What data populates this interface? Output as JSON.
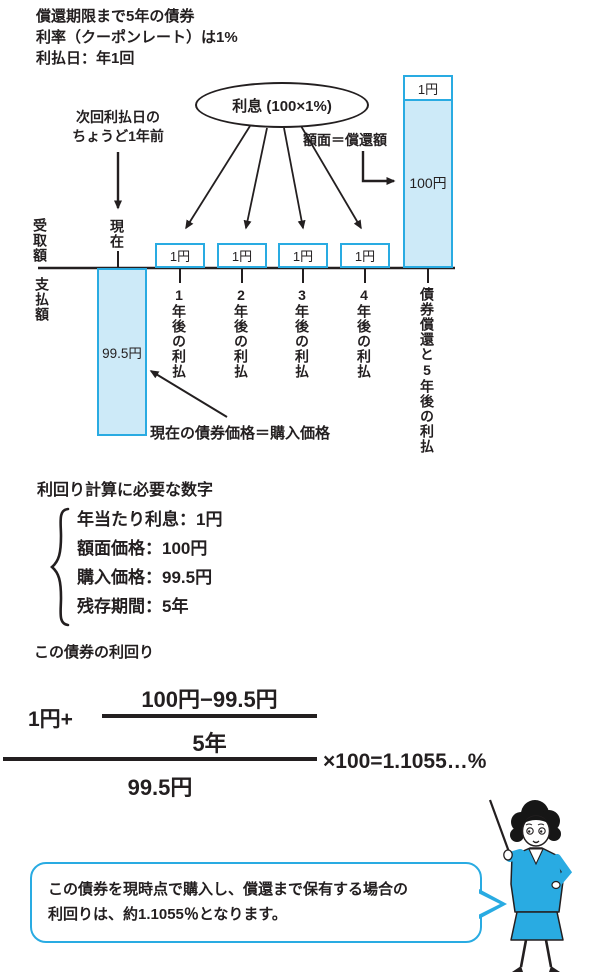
{
  "colors": {
    "accent": "#29abe2",
    "fill": "#cdeaf8",
    "ink": "#231f20"
  },
  "header": {
    "line1": "償還期限まで5年の債券",
    "line2": "利率（クーポンレート）は1%",
    "line3": "利払日：年1回"
  },
  "diagram": {
    "interest_oval": "利息 (100×1%)",
    "next_payment_note_line1": "次回利払日の",
    "next_payment_note_line2": "ちょうど1年前",
    "face_value_note": "額面＝償還額",
    "axis_receive": "受取額",
    "axis_pay": "支払額",
    "now_label": "現在",
    "coupon_boxes": [
      "1円",
      "1円",
      "1円",
      "1円"
    ],
    "top_coupon": "1円",
    "face_value": "100円",
    "purchase_price": "99.5円",
    "price_note": "現在の債券価格＝購入価格",
    "year_labels": [
      "1年後の利払",
      "2年後の利払",
      "3年後の利払",
      "4年後の利払",
      "債券償還と5年後の利払"
    ]
  },
  "required_numbers": {
    "heading": "利回り計算に必要な数字",
    "items": [
      "年当たり利息：1円",
      "額面価格：100円",
      "購入価格：99.5円",
      "残存期間：5年"
    ]
  },
  "yield_section": {
    "heading": "この債券の利回り",
    "coupon_term": "1円+",
    "inner_numerator": "100円−99.5円",
    "inner_denominator": "5年",
    "outer_denominator": "99.5円",
    "result": "×100=1.1055…%"
  },
  "callout": {
    "line1": "この債券を現時点で購入し、償還まで保有する場合の",
    "line2": "利回りは、約1.1055％となります。"
  }
}
